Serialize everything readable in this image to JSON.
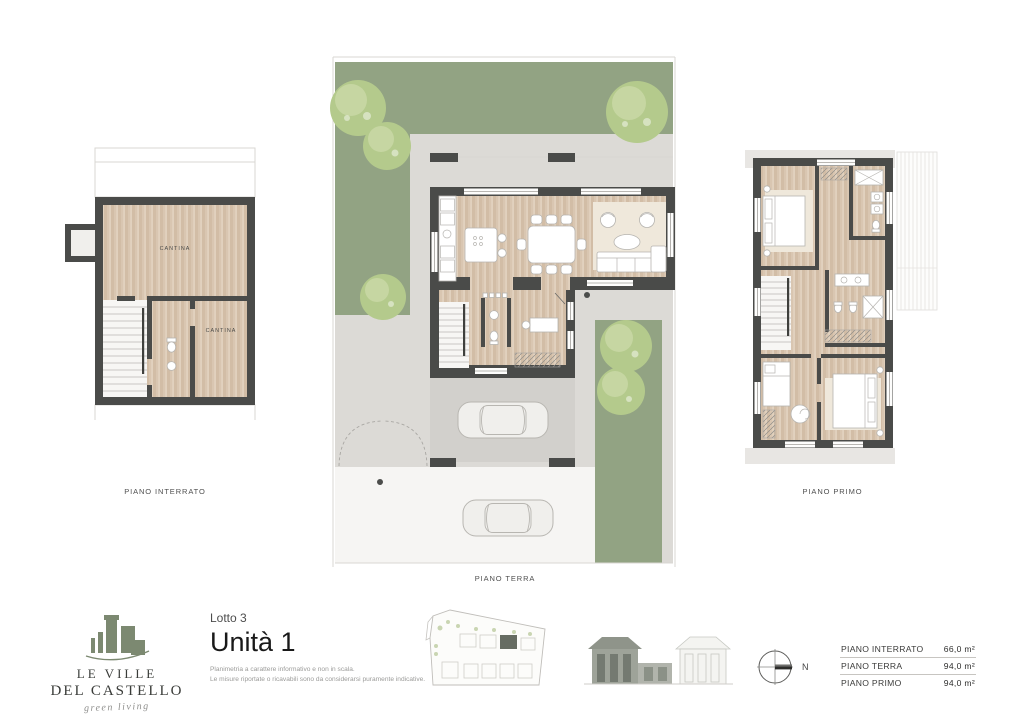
{
  "colors": {
    "lawn": "#92a383",
    "tree": "#b4ca8c",
    "tree_light": "#c9d8a6",
    "patio": "#dcdad6",
    "patio_dark": "#d2d0cc",
    "band": "#e8e6e3",
    "drive": "#f6f5f3",
    "wall": "#4a4b49",
    "wood": "#d9c6b1",
    "wood_stripe": "#cbb49c",
    "rug": "#efe8db",
    "faint": "#d9d7d3",
    "logo_green": "#7c8971",
    "site_highlight": "#666c62"
  },
  "plans": {
    "interrato": {
      "caption": "PIANO INTERRATO",
      "room1": "CANTINA",
      "room2": "CANTINA"
    },
    "terra": {
      "caption": "PIANO TERRA"
    },
    "primo": {
      "caption": "PIANO PRIMO"
    }
  },
  "branding": {
    "logo_line1": "LE VILLE",
    "logo_line2": "DEL CASTELLO",
    "logo_script": "green living",
    "lotto": "Lotto 3",
    "unit": "Unità 1",
    "disclaimer1": "Planimetria a carattere informativo e non in scala.",
    "disclaimer2": "Le misure riportate o ricavabili sono da considerarsi puramente indicative."
  },
  "compass": {
    "north_label": "N"
  },
  "area_table": {
    "rows": [
      {
        "label": "PIANO INTERRATO",
        "value": "66,0 m²"
      },
      {
        "label": "PIANO TERRA",
        "value": "94,0 m²"
      },
      {
        "label": "PIANO PRIMO",
        "value": "94,0 m²"
      }
    ]
  }
}
